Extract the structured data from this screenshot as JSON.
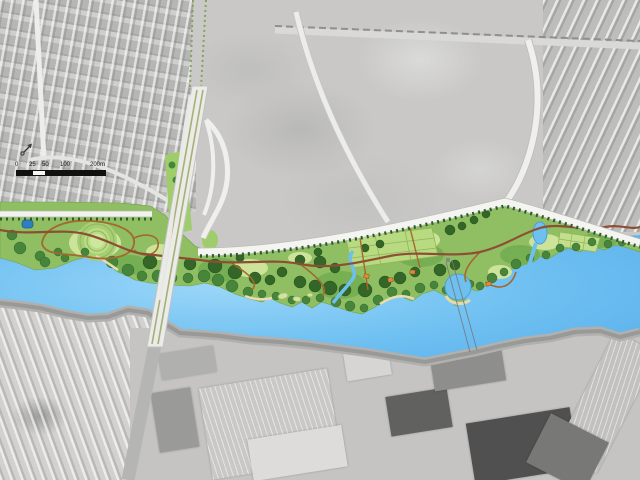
{
  "map": {
    "name": "riverside-park-masterplan-over-aerial-photo",
    "scale_bar": {
      "labels": [
        "0",
        "25",
        "50",
        "100",
        "200m"
      ]
    },
    "north_arrow_icon": "north-arrow-icon",
    "colors": {
      "water": "#72c2f2",
      "water_highlight": "#9bd6f8",
      "park_green": "#8fbf62",
      "lawn_green": "#cde39a",
      "tree_green": "#47853a",
      "tree_dark_green": "#336627",
      "path_brown": "#96602e",
      "main_path_red_brown": "#8d4f33",
      "road_white": "#f3f3f0",
      "bridge_deck": "#ebebe7",
      "bridge_median_green": "#a6b077",
      "aerial_gray": "#c9c8c6",
      "embankment_gray": "#a3a3a1",
      "pond_blue": "#2e7fc0",
      "pavilion_orange": "#e08a3c"
    },
    "features": [
      "aerial-photo-context",
      "residential-area-northwest",
      "open-field-north",
      "residential-area-northeast",
      "riverside-park",
      "river",
      "highway-bridge",
      "industrial-area-south",
      "residential-area-southwest"
    ]
  }
}
